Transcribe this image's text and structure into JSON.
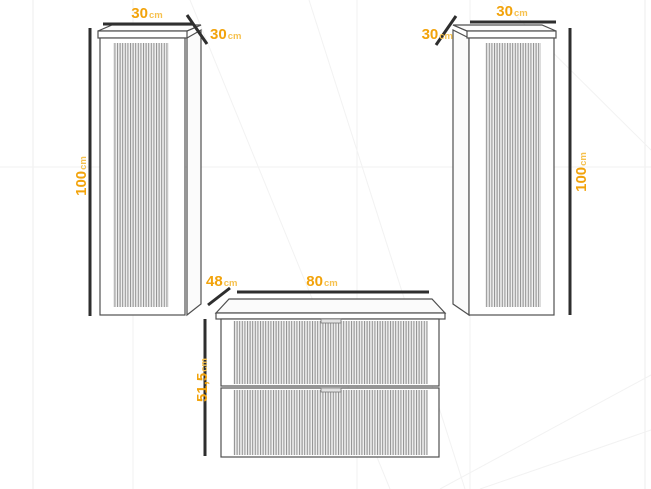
{
  "colors": {
    "dimension_number": "#F2A30B",
    "dimension_unit": "#F6C14E",
    "dimension_line": "#2e2e2e",
    "cabinet_outline": "#4f4f4f",
    "background": "#ffffff"
  },
  "cabinets": {
    "left_tall_cabinet": {
      "name": "tall fluted column cabinet (left)",
      "width": {
        "value": "30",
        "unit": "cm"
      },
      "depth": {
        "value": "30",
        "unit": "cm"
      },
      "height": {
        "value": "100",
        "unit": "cm"
      }
    },
    "right_tall_cabinet": {
      "name": "tall fluted column cabinet (right)",
      "width": {
        "value": "30",
        "unit": "cm"
      },
      "depth": {
        "value": "30",
        "unit": "cm"
      },
      "height": {
        "value": "100",
        "unit": "cm"
      }
    },
    "vanity_unit": {
      "name": "fluted vanity unit with two drawers",
      "depth": {
        "value": "48",
        "unit": "cm"
      },
      "width": {
        "value": "80",
        "unit": "cm"
      },
      "height": {
        "value": "51,5",
        "unit": "cm"
      }
    }
  }
}
